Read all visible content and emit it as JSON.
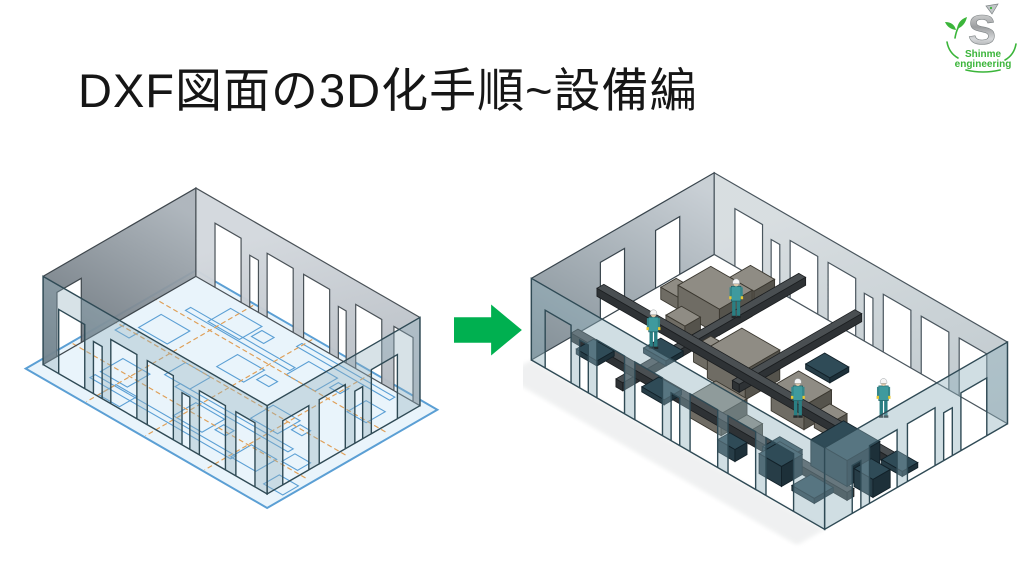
{
  "slide": {
    "title": "DXF図面の3D化手順~設備編"
  },
  "logo": {
    "letter": "S",
    "line1": "Shinme",
    "line2": "engineering"
  },
  "views": {
    "before": "empty-room-with-2d-dxf-floor-plan",
    "after": "room-populated-with-3d-equipment-and-workers"
  },
  "icons": {
    "transform_arrow": "right-block-arrow",
    "logo_mark": "silver-s-snake-with-green-sprout"
  },
  "colors": {
    "background": "#ffffff",
    "title-text": "#161616",
    "arrow-green": "#00b050",
    "logo-green": "#3bb53a",
    "floor-blue": "#e4f1fa",
    "dxf-line-blue": "#5b9fd4",
    "centerline-orange": "#df9f57",
    "glass-teal": "#8fb0bd",
    "glass-edge": "#2f4a55",
    "machine-top": "#8f8c84",
    "machine-left": "#6f6c64",
    "machine-right": "#55534c",
    "teal-top": "#2f4b57",
    "teal-left": "#273d47",
    "teal-right": "#1d3039",
    "rail-dark": "#2e3235",
    "worker-teal": "#3f9a9e",
    "helmet-white": "#f5f5f5"
  }
}
